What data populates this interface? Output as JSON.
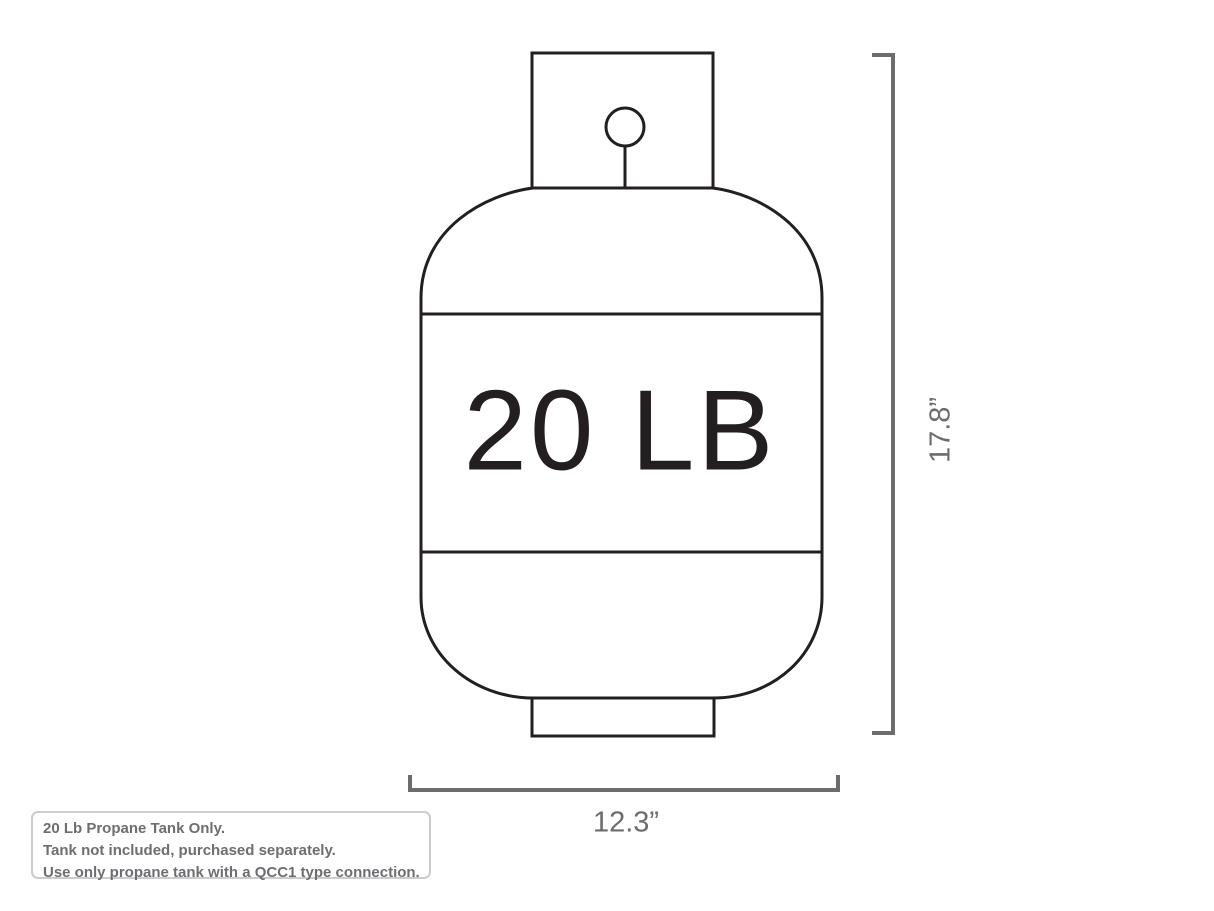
{
  "diagram": {
    "tank_label": "20 LB",
    "height_label": "17.8”",
    "width_label": "12.3”"
  },
  "notes": {
    "lines": [
      "20 Lb Propane Tank Only.",
      "Tank not included, purchased separately.",
      "Use only propane tank with a QCC1 type connection."
    ]
  },
  "colors": {
    "tank_outline": "#231f20",
    "dimension_lines": "#6b6c6e",
    "note_text": "#6d6e71",
    "note_border": "#cbcccd",
    "background": "#ffffff"
  }
}
